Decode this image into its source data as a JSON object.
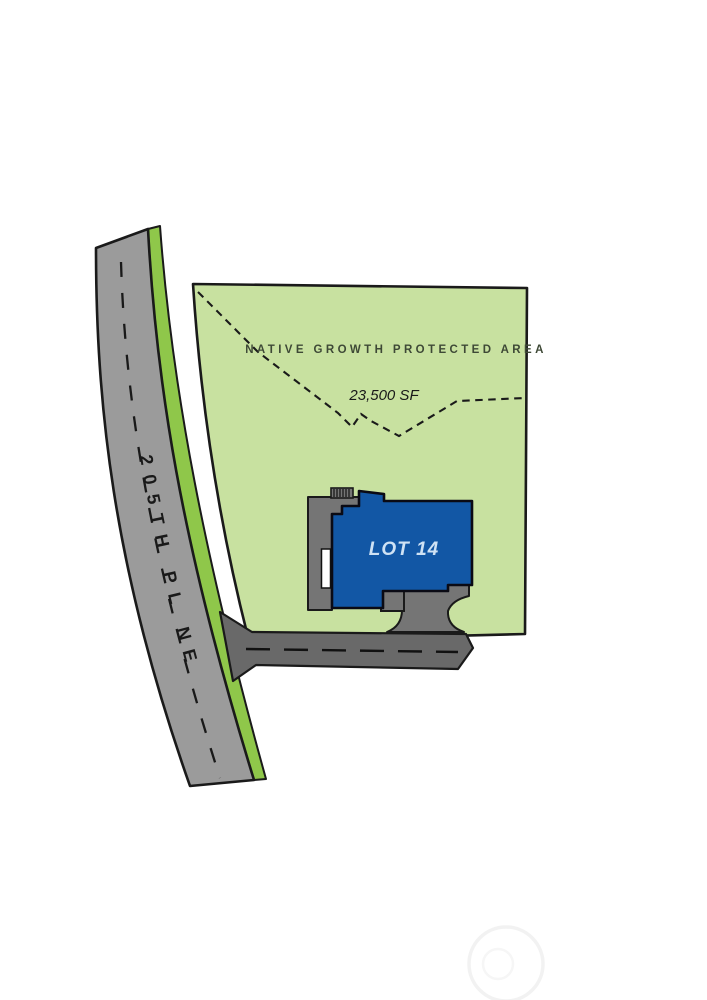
{
  "plan": {
    "road": {
      "name": "205TH PL NE"
    },
    "protected_area": {
      "label": "NATIVE GROWTH PROTECTED AREA",
      "size_label": "23,500 SF"
    },
    "lot": {
      "label": "LOT 14"
    }
  },
  "colors": {
    "lot_green": "#c8e1a0",
    "verge_green": "#8fc74a",
    "road_gray": "#9b9b9b",
    "driveway_gray": "#696969",
    "porch_gray": "#757575",
    "house_blue": "#1257a5",
    "outline": "#1a1a1a",
    "lot_label_text": "#cfe2f4",
    "ngpa_text": "#3e4936",
    "watermark": "#f2f2f2"
  }
}
